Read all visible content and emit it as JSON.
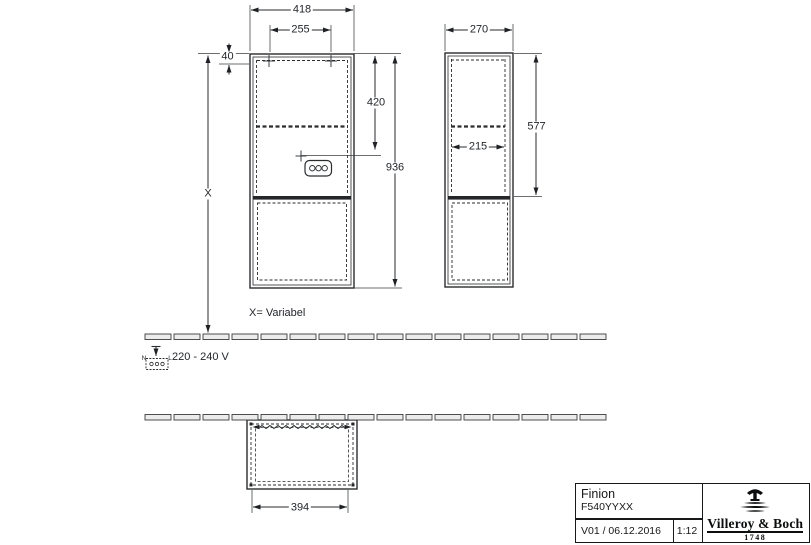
{
  "colors": {
    "line": "#2a2c2e",
    "thin_line": "#3a3c3e",
    "floor_fill": "#ececec",
    "accent_dark": "#17181a"
  },
  "dimensions": {
    "front_width": "418",
    "mount_hole_spacing": "255",
    "mount_hole_offset": "40",
    "outlet_from_top": "420",
    "total_height": "936",
    "height_variable": "X",
    "side_depth": "270",
    "side_open_height": "577",
    "side_inner_depth": "215",
    "bottom_inner_width": "394"
  },
  "annotations": {
    "variable_note": "X= Variabel",
    "voltage": "220 - 240 V",
    "neutral_label": "N",
    "line_label": "L"
  },
  "title_block": {
    "product_name": "Finion",
    "article_number": "F540YYXX",
    "version_date": "V01 / 06.12.2016",
    "scale": "1:12",
    "brand_name": "Villeroy & Boch",
    "brand_year": "1748"
  }
}
